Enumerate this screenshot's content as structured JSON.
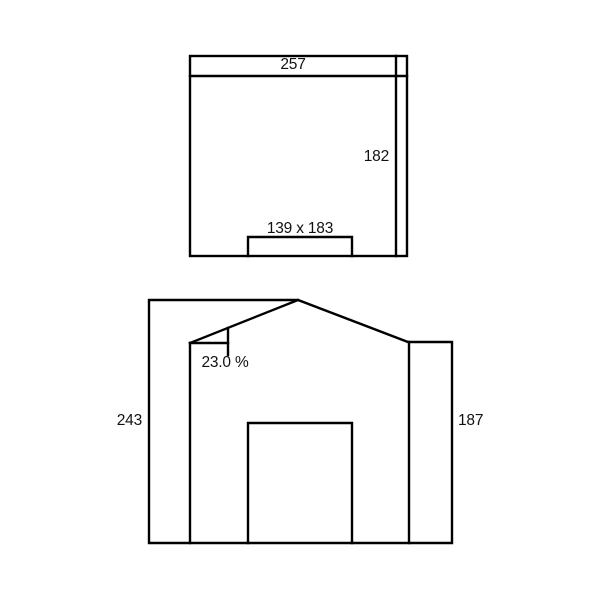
{
  "page": {
    "background_color": "#ffffff",
    "line_color": "#000000",
    "text_color": "#111111"
  },
  "plan_view": {
    "width_dimension": "257",
    "depth_dimension": "182",
    "door_size_dimension": "139 x 183"
  },
  "elevation_view": {
    "roof_slope_dimension": "23.0 %",
    "left_height_dimension": "243",
    "right_height_dimension": "187"
  }
}
